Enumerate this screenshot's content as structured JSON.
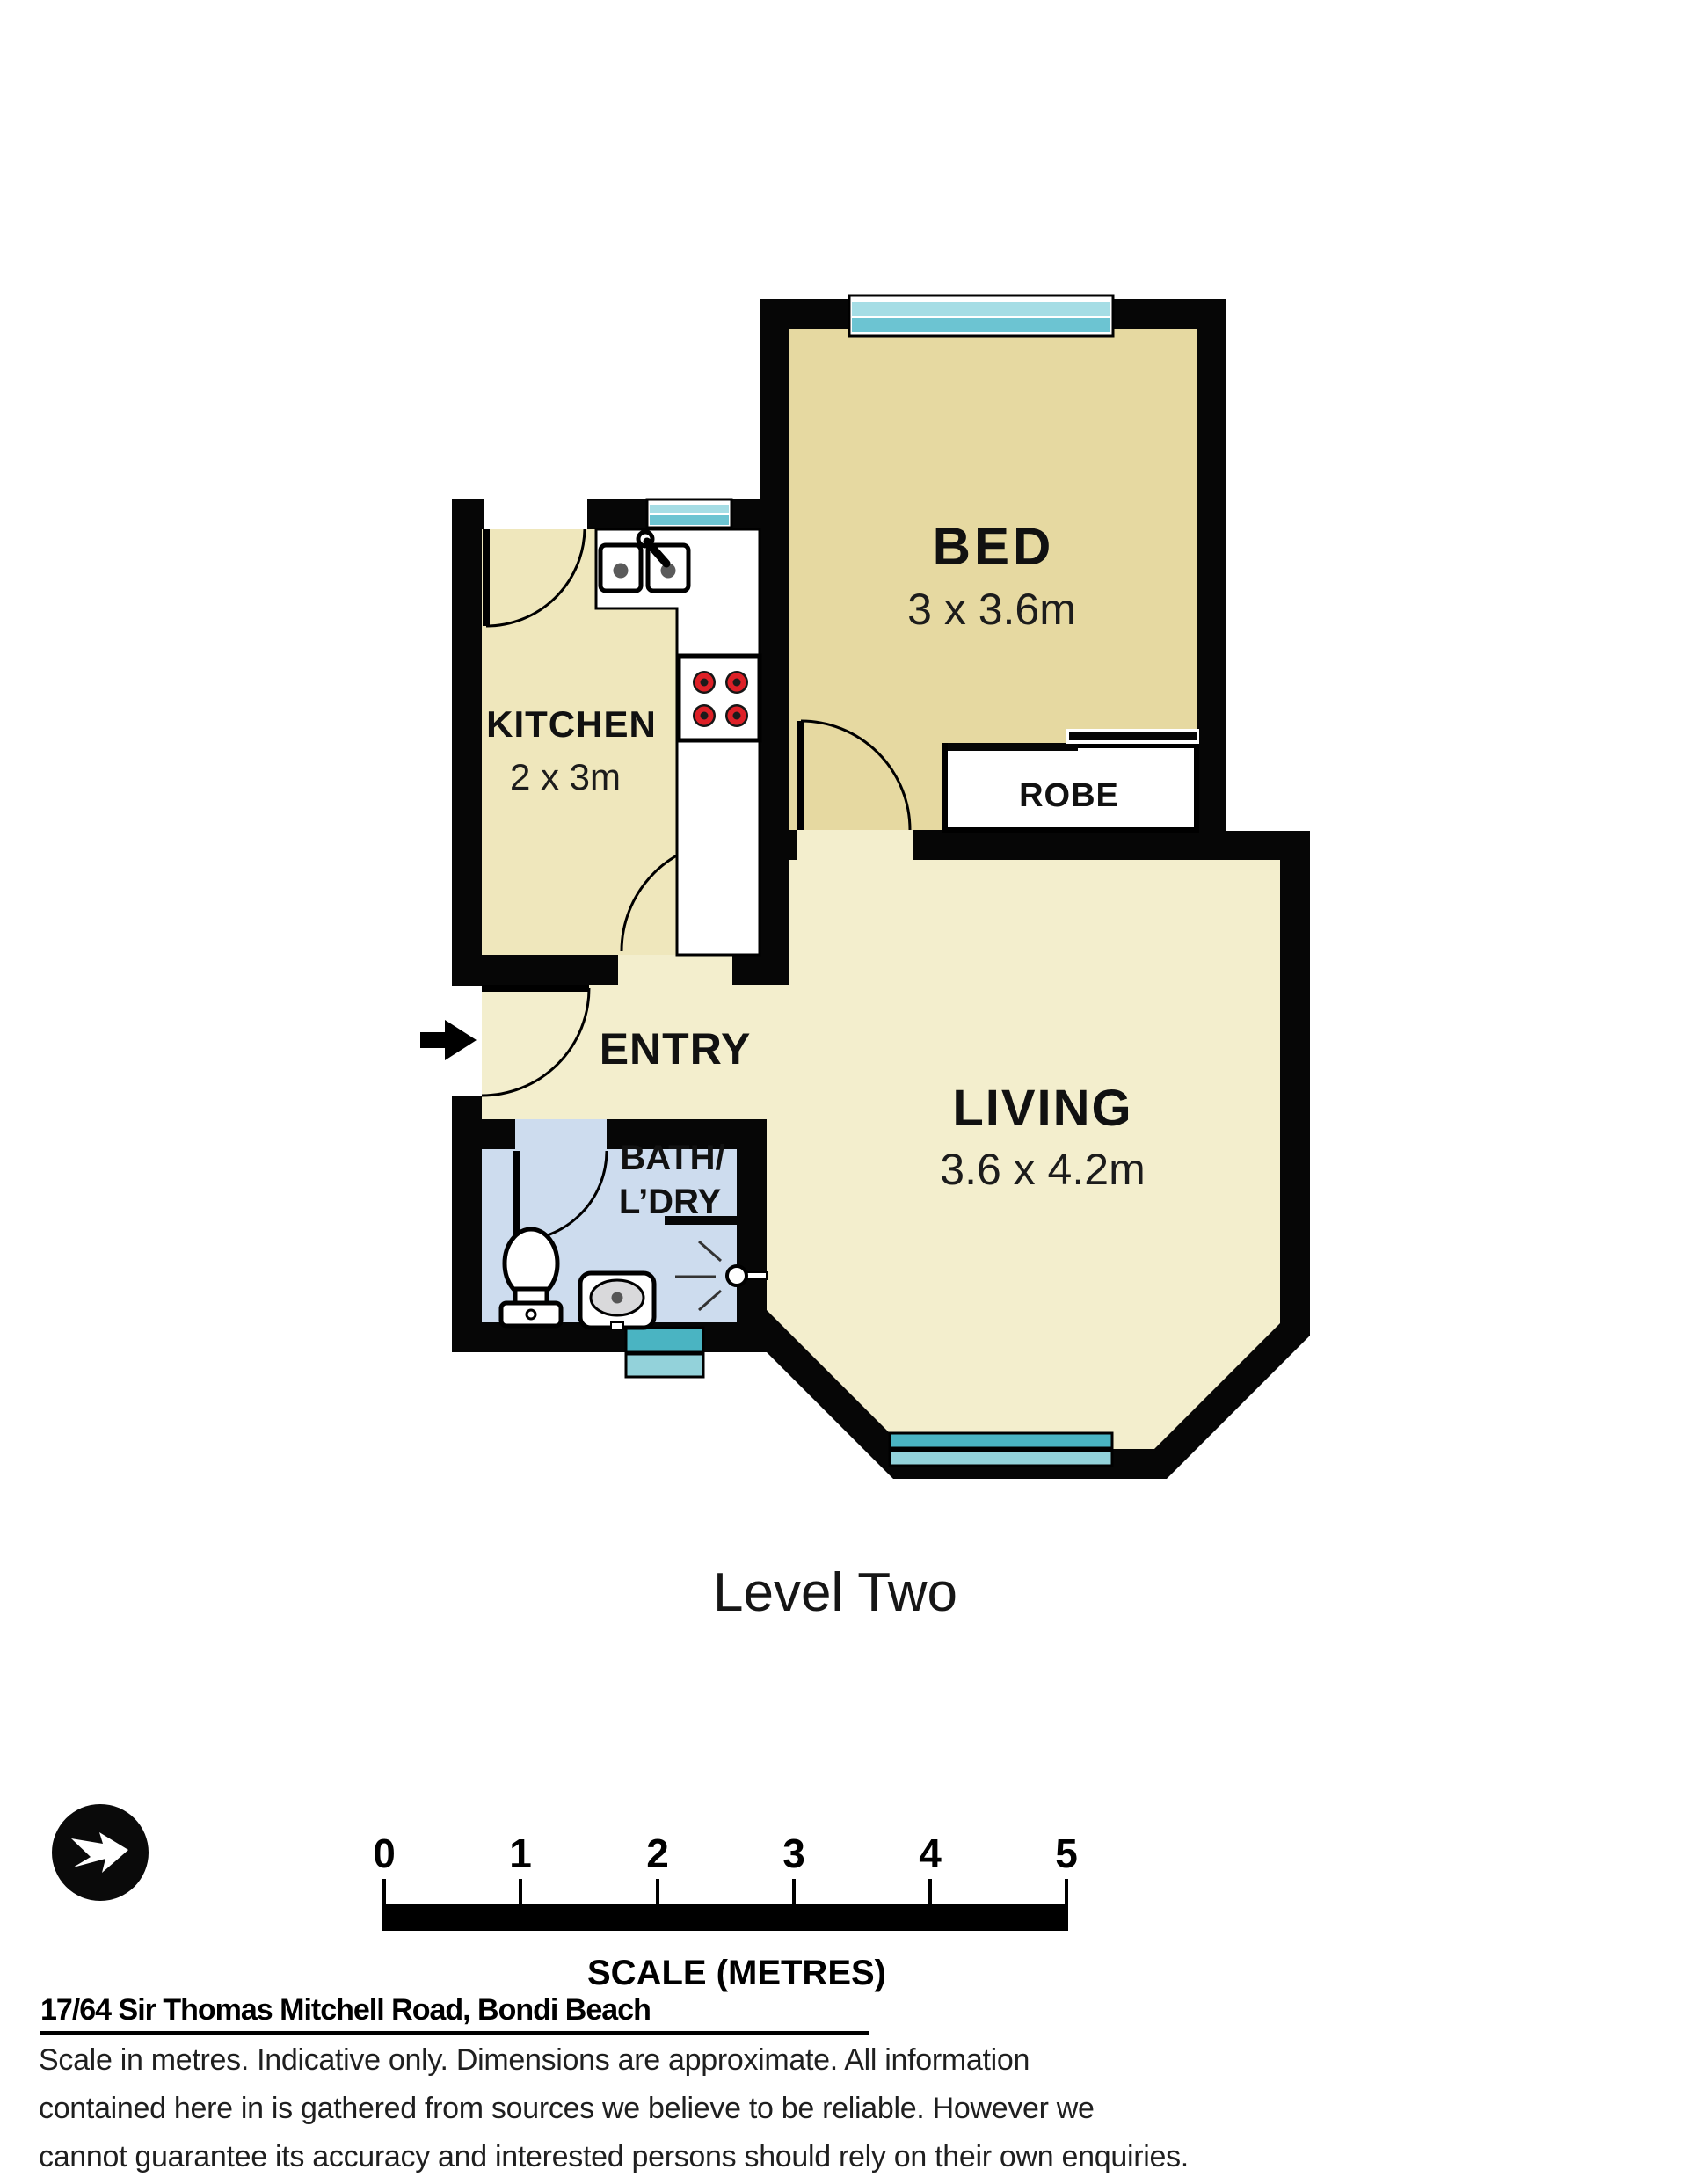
{
  "plan": {
    "rooms": {
      "bed": {
        "name": "BED",
        "dims": "3 x 3.6m"
      },
      "kitchen": {
        "name": "KITCHEN",
        "dims": "2 x 3m"
      },
      "living": {
        "name": "LIVING",
        "dims": "3.6 x 4.2m"
      },
      "entry": {
        "name": "ENTRY"
      },
      "bath": {
        "name": "BATH/",
        "name2": "L’DRY"
      },
      "robe": {
        "name": "ROBE"
      }
    },
    "level_label": "Level Two",
    "colors": {
      "wall": "#060606",
      "floor-bed": "#e6d9a1",
      "floor-kitchen": "#efe7bc",
      "floor-living": "#f3eecd",
      "floor-bath": "#cddcee",
      "window-light": "#a5dde5",
      "window-mid": "#6cc4d2",
      "window-dark": "#4ab4c2",
      "window-pale": "#93d2da",
      "burner-red": "#dd2027",
      "fixture-grey": "#d9d9db"
    }
  },
  "scalebar": {
    "ticks": [
      "0",
      "1",
      "2",
      "3",
      "4",
      "5"
    ],
    "caption": "SCALE (METRES)"
  },
  "footer": {
    "address": "17/64 Sir Thomas Mitchell Road, Bondi Beach",
    "disclaimer": [
      "Scale in metres. Indicative only. Dimensions are approximate. All information",
      "contained here in is gathered from sources we believe to be reliable. However we",
      "cannot guarantee its accuracy and interested persons should rely on their own enquiries."
    ]
  }
}
